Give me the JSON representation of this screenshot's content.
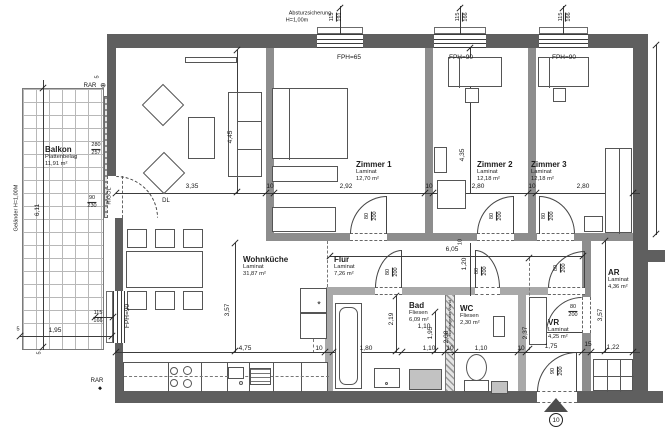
{
  "drawing_type": "apartment floor plan",
  "entrance": {
    "number": "10"
  },
  "colors": {
    "wall_exterior": "#5f5f5f",
    "wall_interior": "#8d8d8d",
    "wall_nonbearing": "#a9a9a9",
    "line": "#3c3c3c",
    "background": "#ffffff"
  },
  "rooms": [
    {
      "n": "room-label-balkon",
      "name": "Balkon",
      "floor": "Plattenbelag",
      "area": "11,91 m²",
      "x": 45,
      "y": 145
    },
    {
      "n": "room-label-wohnkueche",
      "name": "Wohnküche",
      "floor": "Laminat",
      "area": "31,87 m²",
      "x": 243,
      "y": 255
    },
    {
      "n": "room-label-zimmer-1",
      "name": "Zimmer 1",
      "floor": "Laminat",
      "area": "12,70 m²",
      "x": 356,
      "y": 160
    },
    {
      "n": "room-label-zimmer-2",
      "name": "Zimmer 2",
      "floor": "Laminat",
      "area": "12,18 m²",
      "x": 477,
      "y": 160
    },
    {
      "n": "room-label-zimmer-3",
      "name": "Zimmer 3",
      "floor": "Laminat",
      "area": "12,18 m²",
      "x": 531,
      "y": 160
    },
    {
      "n": "room-label-flur",
      "name": "Flur",
      "floor": "Laminat",
      "area": "7,26 m²",
      "x": 334,
      "y": 255
    },
    {
      "n": "room-label-bad",
      "name": "Bad",
      "floor": "Fliesen",
      "area": "6,09 m²",
      "x": 409,
      "y": 301
    },
    {
      "n": "room-label-wc",
      "name": "WC",
      "floor": "Fliesen",
      "area": "2,30 m²",
      "x": 460,
      "y": 304
    },
    {
      "n": "room-label-vr",
      "name": "VR",
      "floor": "Laminat",
      "area": "4,25 m²",
      "x": 548,
      "y": 318
    },
    {
      "n": "room-label-ar",
      "name": "AR",
      "floor": "Laminat",
      "area": "4,36 m²",
      "x": 608,
      "y": 268
    }
  ],
  "labels": [
    {
      "n": "note-absturzsicherung-line1",
      "t": "Absturzsicherung",
      "x": 310,
      "y": 14,
      "fs": 5.5
    },
    {
      "n": "note-absturzsicherung-line2",
      "t": "H=1,00m",
      "x": 297,
      "y": 21,
      "fs": 5.5
    },
    {
      "n": "label-fph-65",
      "t": "FPH=65",
      "x": 349,
      "y": 58
    },
    {
      "n": "label-fph-90-z2",
      "t": "FPH=90",
      "x": 461,
      "y": 58
    },
    {
      "n": "label-fph-90-z3",
      "t": "FPH=90",
      "x": 564,
      "y": 58
    },
    {
      "n": "label-fph-90-left",
      "t": "FPH=90",
      "x": 128,
      "y": 316,
      "r": -90
    },
    {
      "n": "label-rar-top",
      "t": "RAR",
      "x": 90,
      "y": 86,
      "fs": 6
    },
    {
      "n": "rar-marker-top-icon",
      "t": "⊕",
      "x": 103,
      "y": 86,
      "fs": 7
    },
    {
      "n": "label-rar-bottom",
      "t": "RAR",
      "x": 97,
      "y": 381,
      "fs": 6
    },
    {
      "n": "rar-marker-bottom-icon",
      "t": "◆",
      "x": 100,
      "y": 389,
      "fs": 5
    },
    {
      "n": "label-rigol",
      "t": "RIGOL",
      "x": 110,
      "y": 196,
      "r": -90,
      "fs": 5.5
    },
    {
      "n": "label-gelaender",
      "t": "Geländer H=1,00M",
      "x": 17,
      "y": 208,
      "r": -90,
      "fs": 5.5
    },
    {
      "n": "label-dl",
      "t": "DL",
      "x": 166,
      "y": 201,
      "fs": 6
    },
    {
      "n": "label-nichttragende-wand",
      "t": "nichttragende Wand",
      "x": 450,
      "y": 318,
      "r": -90,
      "fs": 4
    },
    {
      "n": "symbol-asterisk",
      "t": "*",
      "x": 319,
      "y": 305,
      "fs": 9
    },
    {
      "n": "dim-3-35",
      "t": "3,35",
      "x": 192,
      "y": 187
    },
    {
      "n": "dim-10-a",
      "t": "10",
      "x": 270,
      "y": 187
    },
    {
      "n": "dim-2-92",
      "t": "2,92",
      "x": 346,
      "y": 187
    },
    {
      "n": "dim-10-b",
      "t": "10",
      "x": 429,
      "y": 187
    },
    {
      "n": "dim-2-80-a",
      "t": "2,80",
      "x": 478,
      "y": 187
    },
    {
      "n": "dim-10-c",
      "t": "10",
      "x": 532,
      "y": 187
    },
    {
      "n": "dim-2-80-b",
      "t": "2,80",
      "x": 583,
      "y": 187
    },
    {
      "n": "dim-4-45",
      "t": "4,45",
      "x": 231,
      "y": 137,
      "r": -90
    },
    {
      "n": "dim-4-35",
      "t": "4,35",
      "x": 463,
      "y": 155,
      "r": -90
    },
    {
      "n": "dim-3-57-left",
      "t": "3,57",
      "x": 228,
      "y": 310,
      "r": -90
    },
    {
      "n": "dim-4-75",
      "t": "4,75",
      "x": 245,
      "y": 349
    },
    {
      "n": "dim-10-d",
      "t": "10",
      "x": 319,
      "y": 349
    },
    {
      "n": "dim-1-80",
      "t": "1,80",
      "x": 366,
      "y": 349
    },
    {
      "n": "dim-1-10-a",
      "t": "1,10",
      "x": 429,
      "y": 349
    },
    {
      "n": "dim-10-e",
      "t": "10",
      "x": 450,
      "y": 349
    },
    {
      "n": "dim-1-10-b",
      "t": "1,10",
      "x": 481,
      "y": 349
    },
    {
      "n": "dim-10-f",
      "t": "10",
      "x": 521,
      "y": 349
    },
    {
      "n": "dim-1-75",
      "t": "1,75",
      "x": 551,
      "y": 347
    },
    {
      "n": "dim-15",
      "t": "15",
      "x": 588,
      "y": 345
    },
    {
      "n": "dim-1-22",
      "t": "1,22",
      "x": 613,
      "y": 348
    },
    {
      "n": "dim-1-10-c",
      "t": "1,10",
      "x": 424,
      "y": 327
    },
    {
      "n": "dim-2-19",
      "t": "2,19",
      "x": 392,
      "y": 319,
      "r": -90
    },
    {
      "n": "dim-1-95-bad",
      "t": "1,95",
      "x": 431,
      "y": 333,
      "r": -90
    },
    {
      "n": "dim-2-08",
      "t": "2,08",
      "x": 447,
      "y": 337,
      "r": -90
    },
    {
      "n": "dim-2-37",
      "t": "2,37",
      "x": 526,
      "y": 333,
      "r": -90
    },
    {
      "n": "dim-3-57-right",
      "t": "3,57",
      "x": 601,
      "y": 315,
      "r": -90
    },
    {
      "n": "dim-6-05",
      "t": "6,05",
      "x": 452,
      "y": 250
    },
    {
      "n": "dim-1-20",
      "t": "1,20",
      "x": 465,
      "y": 264,
      "r": -90
    },
    {
      "n": "dim-10-g",
      "t": "10",
      "x": 461,
      "y": 242,
      "r": -90,
      "fs": 5.5
    },
    {
      "n": "dim-6-11",
      "t": "6,11",
      "x": 38,
      "y": 210,
      "r": -90
    },
    {
      "n": "dim-1-95-balkon",
      "t": "1,95",
      "x": 55,
      "y": 331
    },
    {
      "n": "dim-5-a",
      "t": "5",
      "x": 98,
      "y": 77,
      "r": -90,
      "fs": 5.5
    },
    {
      "n": "dim-5-b",
      "t": "5",
      "x": 18,
      "y": 330,
      "fs": 5.5
    },
    {
      "n": "dim-5-c",
      "t": "5",
      "x": 40,
      "y": 353,
      "r": -90,
      "fs": 5.5
    }
  ],
  "fractions": [
    {
      "n": "dim-balkon-parapet",
      "top": "280",
      "bot": "257",
      "x": 96,
      "y": 149
    },
    {
      "n": "dim-door-balkon",
      "top": "90",
      "bot": "230",
      "x": 92,
      "y": 202
    },
    {
      "n": "dim-window-left",
      "top": "115",
      "bot": "166",
      "x": 98,
      "y": 317
    },
    {
      "n": "dim-window-z1",
      "top": "115",
      "bot": "191",
      "x": 336,
      "y": 17,
      "r": -90
    },
    {
      "n": "dim-window-z2",
      "top": "115",
      "bot": "166",
      "x": 462,
      "y": 17,
      "r": -90
    },
    {
      "n": "dim-window-z3",
      "top": "115",
      "bot": "166",
      "x": 565,
      "y": 17,
      "r": -90
    },
    {
      "n": "dim-door-z1",
      "top": "80",
      "bot": "200",
      "x": 371,
      "y": 216,
      "r": -90
    },
    {
      "n": "dim-door-z2",
      "top": "80",
      "bot": "200",
      "x": 496,
      "y": 216,
      "r": -90
    },
    {
      "n": "dim-door-z3",
      "top": "80",
      "bot": "200",
      "x": 548,
      "y": 216,
      "r": -90
    },
    {
      "n": "dim-door-bad",
      "top": "80",
      "bot": "200",
      "x": 392,
      "y": 272,
      "r": -90
    },
    {
      "n": "dim-door-wc",
      "top": "80",
      "bot": "200",
      "x": 481,
      "y": 271,
      "r": -90
    },
    {
      "n": "dim-door-flur-vr",
      "top": "80",
      "bot": "200",
      "x": 560,
      "y": 268,
      "r": -90
    },
    {
      "n": "dim-door-vr-ar",
      "top": "80",
      "bot": "200",
      "x": 573,
      "y": 311
    },
    {
      "n": "dim-door-entrance",
      "top": "90",
      "bot": "200",
      "x": 557,
      "y": 371,
      "r": -90
    }
  ]
}
